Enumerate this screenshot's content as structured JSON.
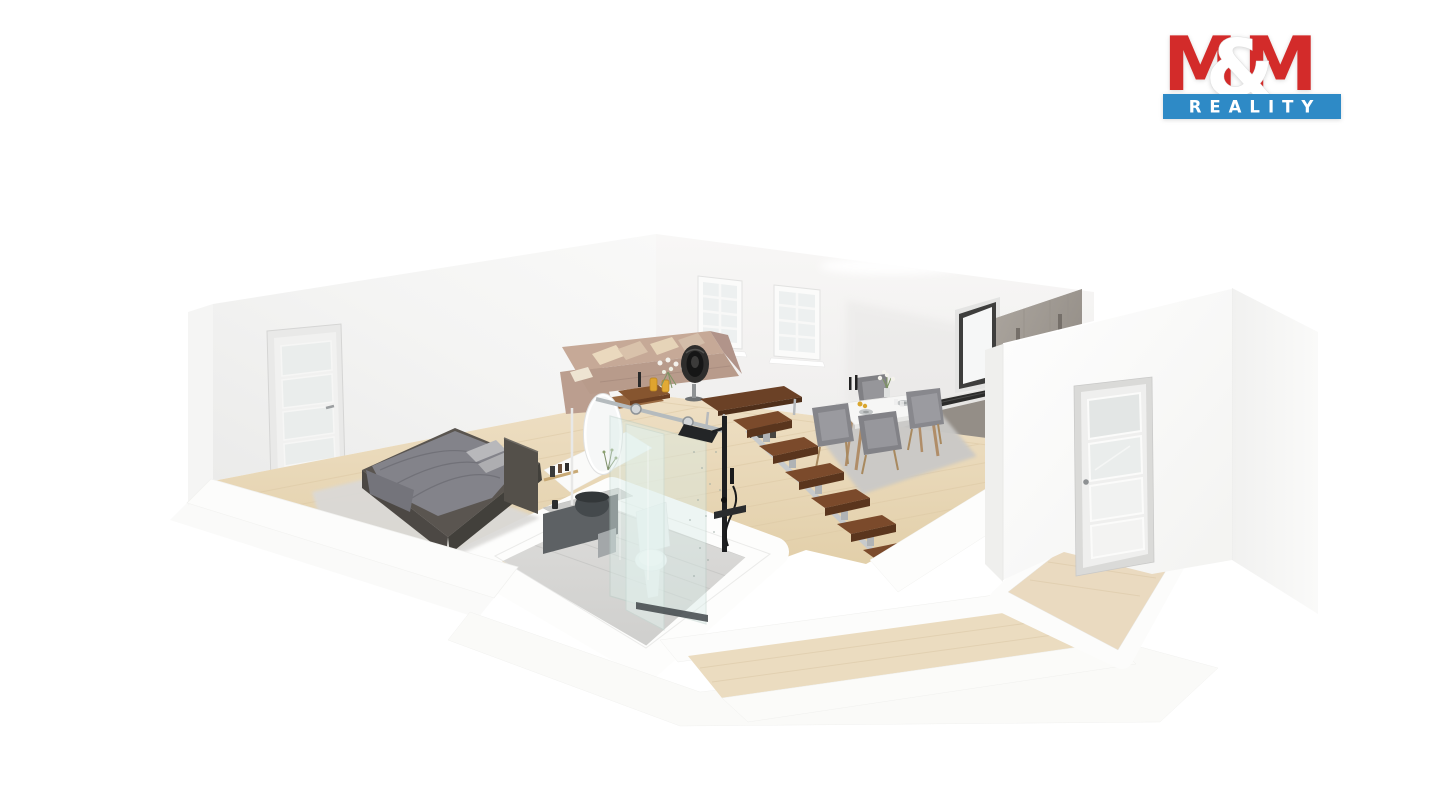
{
  "window": {
    "width_px": 1440,
    "height_px": 810,
    "background": "#ffffff"
  },
  "logo": {
    "m_left": "M",
    "ampersand": "&",
    "m_right": "M",
    "reality": "REALITY",
    "colors": {
      "red": "#d32b2a",
      "blue": "#2e8ac6",
      "text": "#ffffff"
    }
  },
  "scene": {
    "type": "3d-cutaway-floorplan-render",
    "rooms": [
      {
        "id": "bedroom",
        "furniture": [
          "double-bed",
          "gray-blanket",
          "pillows",
          "shaggy-rug",
          "glazed-interior-door"
        ]
      },
      {
        "id": "bathroom",
        "furniture": [
          "vanity-cabinet",
          "vessel-sink",
          "oval-mirror",
          "toilet",
          "glass-shower-enclosure",
          "black-shower-column",
          "towel",
          "slim-floor-lamp"
        ]
      },
      {
        "id": "living-room",
        "furniture": [
          "l-shaped-sofa",
          "throw-pillows",
          "nesting-coffee-tables",
          "black-pedestal-fan",
          "walnut-desk",
          "two-back-wall-windows"
        ]
      },
      {
        "id": "dining-room",
        "furniture": [
          "white-dining-table",
          "four-gray-chairs",
          "gray-rug",
          "vase-candles-plates"
        ]
      },
      {
        "id": "kitchen",
        "furniture": [
          "tall-gray-cabinets",
          "cooktop-counter",
          "kitchen-window"
        ]
      },
      {
        "id": "hallway",
        "furniture": [
          "glazed-entry-door",
          "floating-wood-stairs",
          "entry-wood-floor",
          "lower-corridor"
        ]
      }
    ],
    "palette": {
      "walls": "#f4f4f3",
      "wood_floor": "#e8d7b9",
      "bathroom_tile": "#d9d9d7",
      "bed_frame": "#57524d",
      "blanket": "#85858a",
      "sofa": "#c0a494",
      "stair_tread": "#7a492c",
      "cabinet_gray": "#9d978f",
      "shower_glass": "#ddeee9",
      "fixture_black": "#202122"
    }
  }
}
